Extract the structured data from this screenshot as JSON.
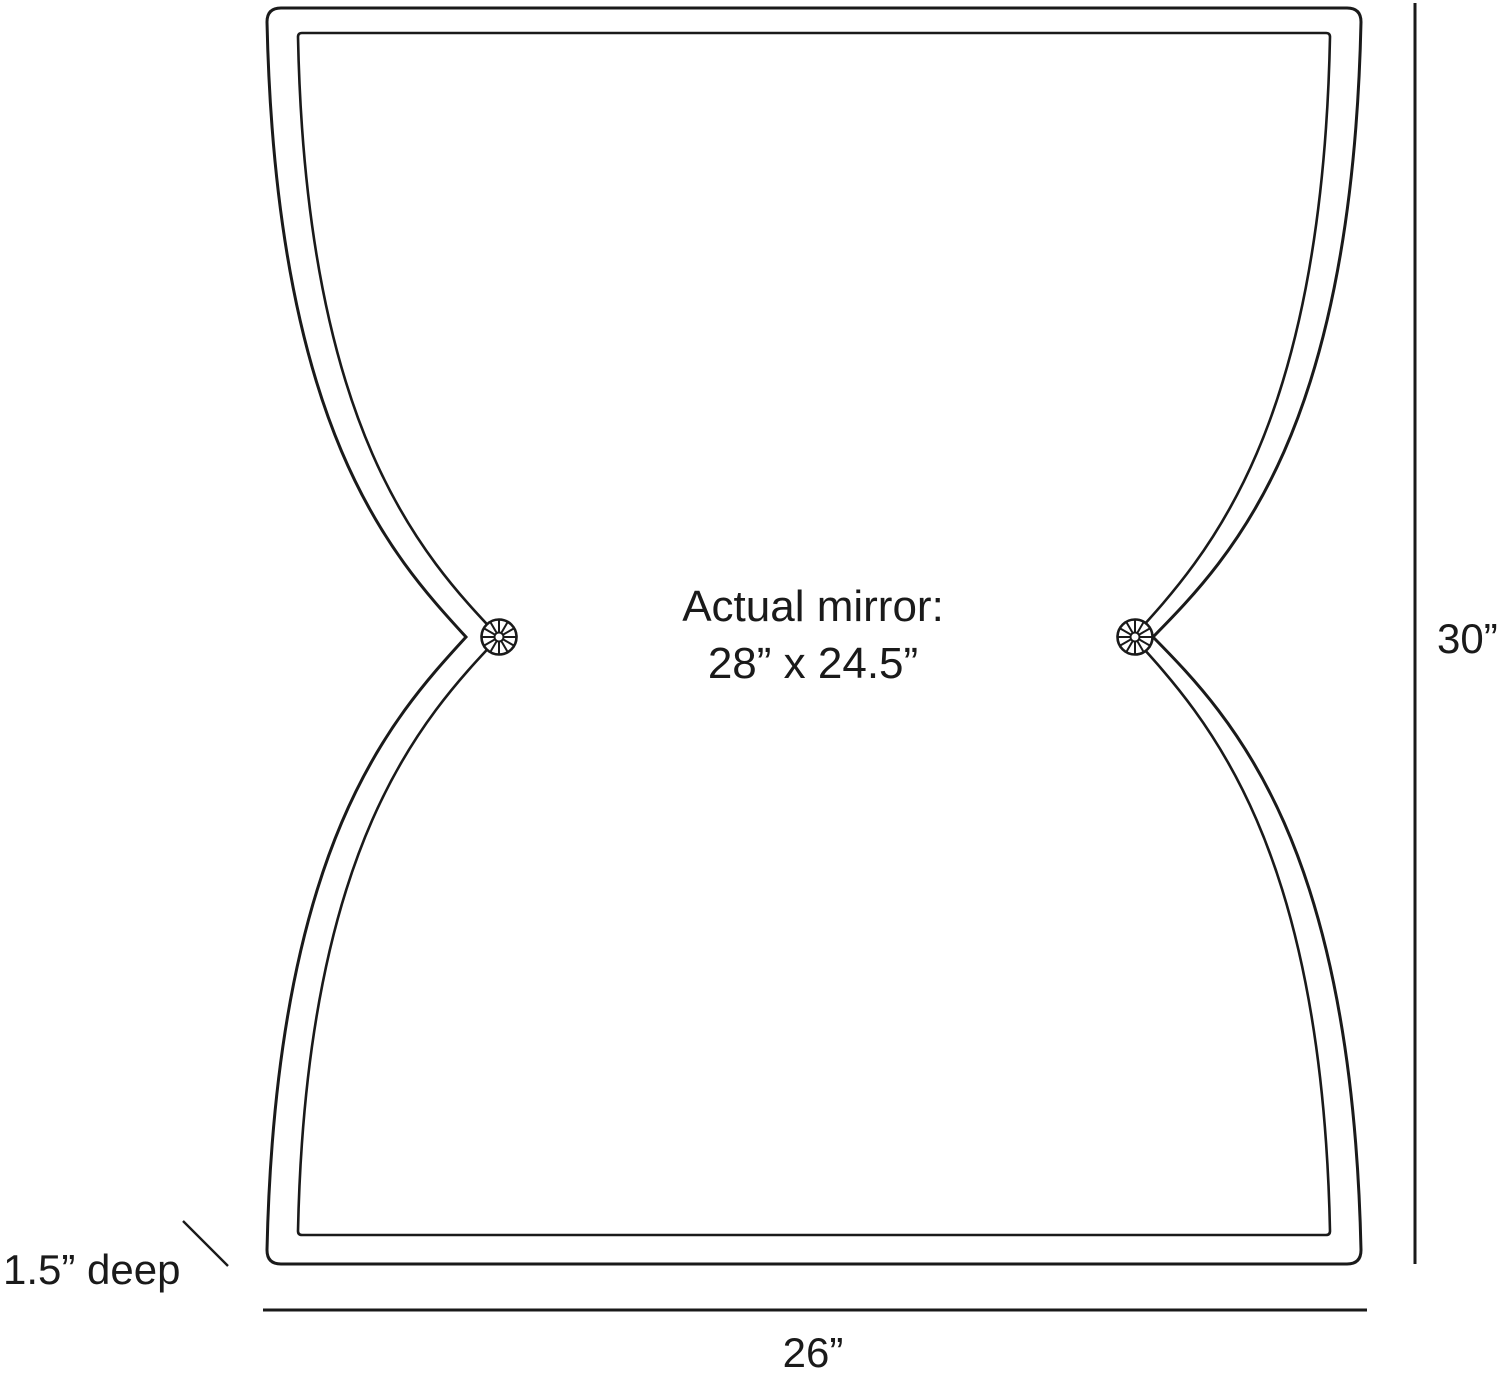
{
  "diagram": {
    "center_label": {
      "line1": "Actual mirror:",
      "line2": "28” x 24.5”"
    },
    "dimensions": {
      "height": "30”",
      "width": "26”",
      "depth": "1.5” deep"
    },
    "icons": {
      "left_pinch": "rosette-icon",
      "right_pinch": "rosette-icon"
    },
    "colors": {
      "line": "#1a1a1a",
      "background": "#ffffff"
    }
  }
}
